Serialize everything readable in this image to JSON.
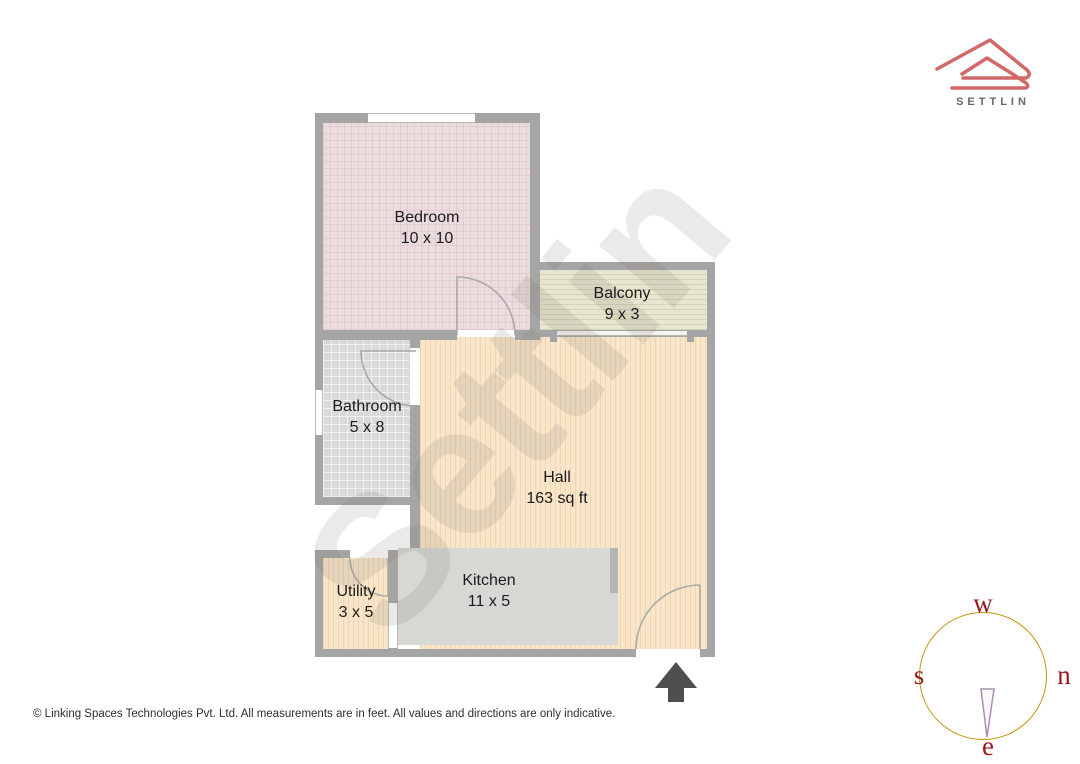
{
  "brand": {
    "logo_text": "SETTLIN",
    "logo_color": "#d36868",
    "logo_text_color": "#666666"
  },
  "floor_plan": {
    "watermark": "Settlin",
    "wall_color": "#a5a5a5",
    "rooms": [
      {
        "name": "Bedroom",
        "dimensions": "10 x 10",
        "fill": "#ebdcdd"
      },
      {
        "name": "Balcony",
        "dimensions": "9 x 3",
        "fill": "#e8e6cf"
      },
      {
        "name": "Bathroom",
        "dimensions": "5 x 8",
        "fill": "#d9d9d9"
      },
      {
        "name": "Hall",
        "dimensions": "163 sq ft",
        "fill": "#f9e5c8"
      },
      {
        "name": "Utility",
        "dimensions": "3 x 5",
        "fill": "#f9e5c8"
      },
      {
        "name": "Kitchen",
        "dimensions": "11 x 5",
        "fill": "#d5d8d3"
      }
    ]
  },
  "compass": {
    "top": "w",
    "right": "n",
    "bottom": "e",
    "left": "s",
    "ring_color": "#c9920e",
    "letter_color": "#98191c"
  },
  "footer": {
    "text": "© Linking Spaces Technologies Pvt. Ltd. All measurements are in feet. All values and directions are only indicative."
  }
}
